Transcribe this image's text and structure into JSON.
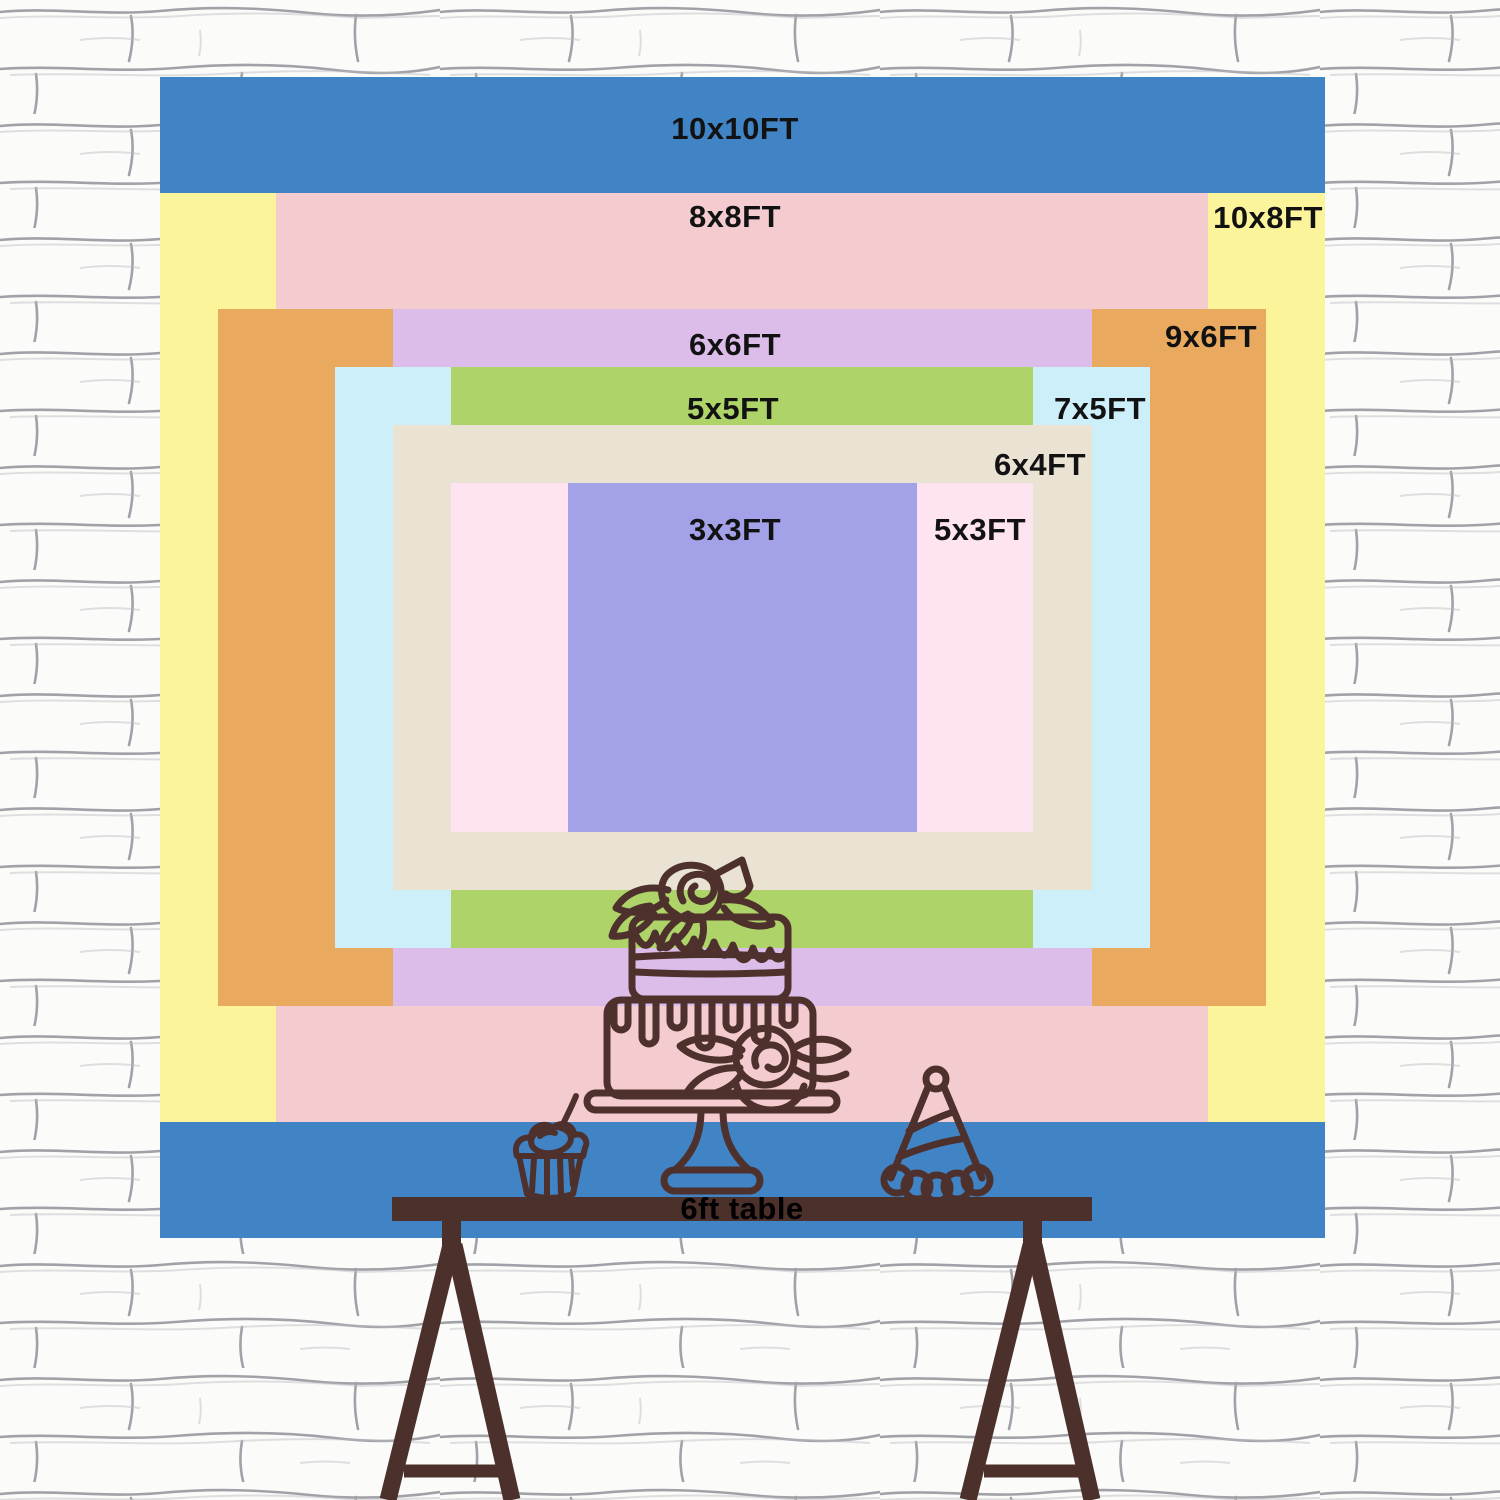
{
  "backdrop": {
    "description": "nested backdrop size comparison chart",
    "sizes": [
      {
        "id": "10x10",
        "label": "10x10FT",
        "color": "#4184c6",
        "width_ft": 10,
        "height_ft": 10
      },
      {
        "id": "10x8",
        "label": "10x8FT",
        "color": "#fcf49b",
        "width_ft": 10,
        "height_ft": 8
      },
      {
        "id": "8x8",
        "label": "8x8FT",
        "color": "#f4ccd0",
        "width_ft": 8,
        "height_ft": 8
      },
      {
        "id": "9x6",
        "label": "9x6FT",
        "color": "#e9a95f",
        "width_ft": 9,
        "height_ft": 6
      },
      {
        "id": "6x6",
        "label": "6x6FT",
        "color": "#dcbde9",
        "width_ft": 6,
        "height_ft": 6
      },
      {
        "id": "7x5",
        "label": "7x5FT",
        "color": "#cdeff9",
        "width_ft": 7,
        "height_ft": 5
      },
      {
        "id": "5x5",
        "label": "5x5FT",
        "color": "#aed469",
        "width_ft": 5,
        "height_ft": 5
      },
      {
        "id": "6x4",
        "label": "6x4FT",
        "color": "#eae3d3",
        "width_ft": 6,
        "height_ft": 4
      },
      {
        "id": "5x3",
        "label": "5x3FT",
        "color": "#fee3f0",
        "width_ft": 5,
        "height_ft": 3
      },
      {
        "id": "3x3",
        "label": "3x3FT",
        "color": "#a3a1e8",
        "width_ft": 3,
        "height_ft": 3
      }
    ],
    "label_color": "#121212"
  },
  "table": {
    "label": "6ft table",
    "color": "#4c302b"
  },
  "drawings": {
    "line_color": "#4e312c",
    "items": [
      "cupcake-icon",
      "birthday-cake-icon",
      "party-hat-icon"
    ]
  },
  "wall": {
    "description": "white painted brick wall",
    "mortar_color": "#8d8d96"
  }
}
